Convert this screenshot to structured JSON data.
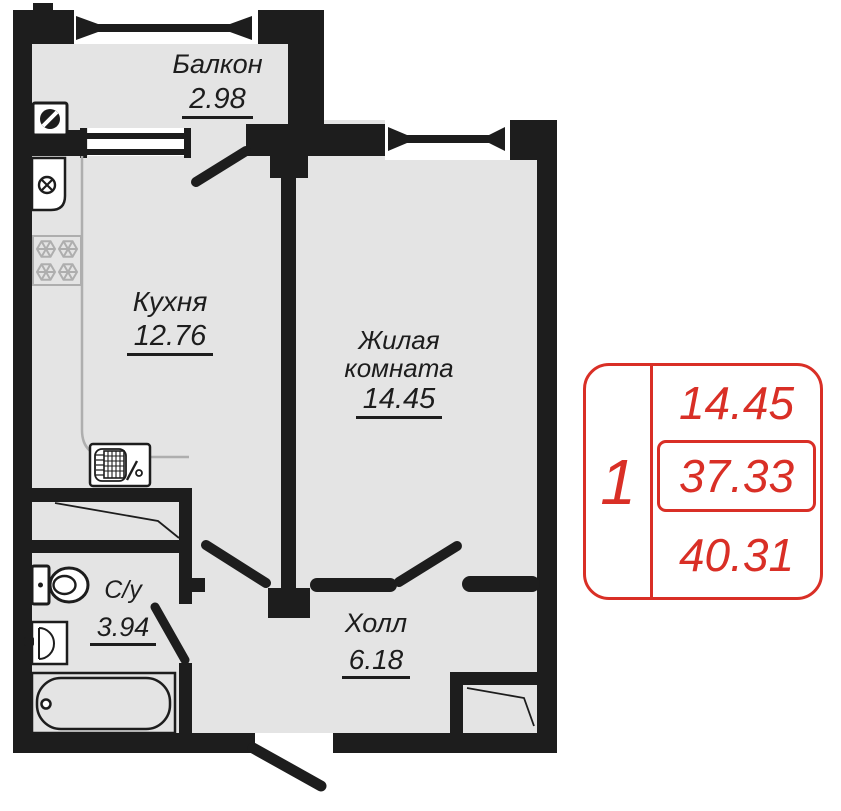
{
  "title": "Однокомнатная квартира — план",
  "rooms": {
    "balcony": {
      "label": "Балкон",
      "area": "2.98"
    },
    "kitchen": {
      "label": "Кухня",
      "area": "12.76"
    },
    "living_room": {
      "label": "Жилая комната",
      "area": "14.45"
    },
    "bathroom": {
      "label": "С/у",
      "area": "3.94"
    },
    "hall": {
      "label": "Холл",
      "area": "6.18"
    }
  },
  "stamp": {
    "room_count": "1",
    "living_area": "14.45",
    "area_without_balcony": "37.33",
    "total_area": "40.31"
  },
  "colors": {
    "walls": "#1d1d1d",
    "floor": "#e4e4e4",
    "light_fixture_lines": "#aeaeae",
    "stamp_red": "#d92f26",
    "background": "#ffffff"
  }
}
